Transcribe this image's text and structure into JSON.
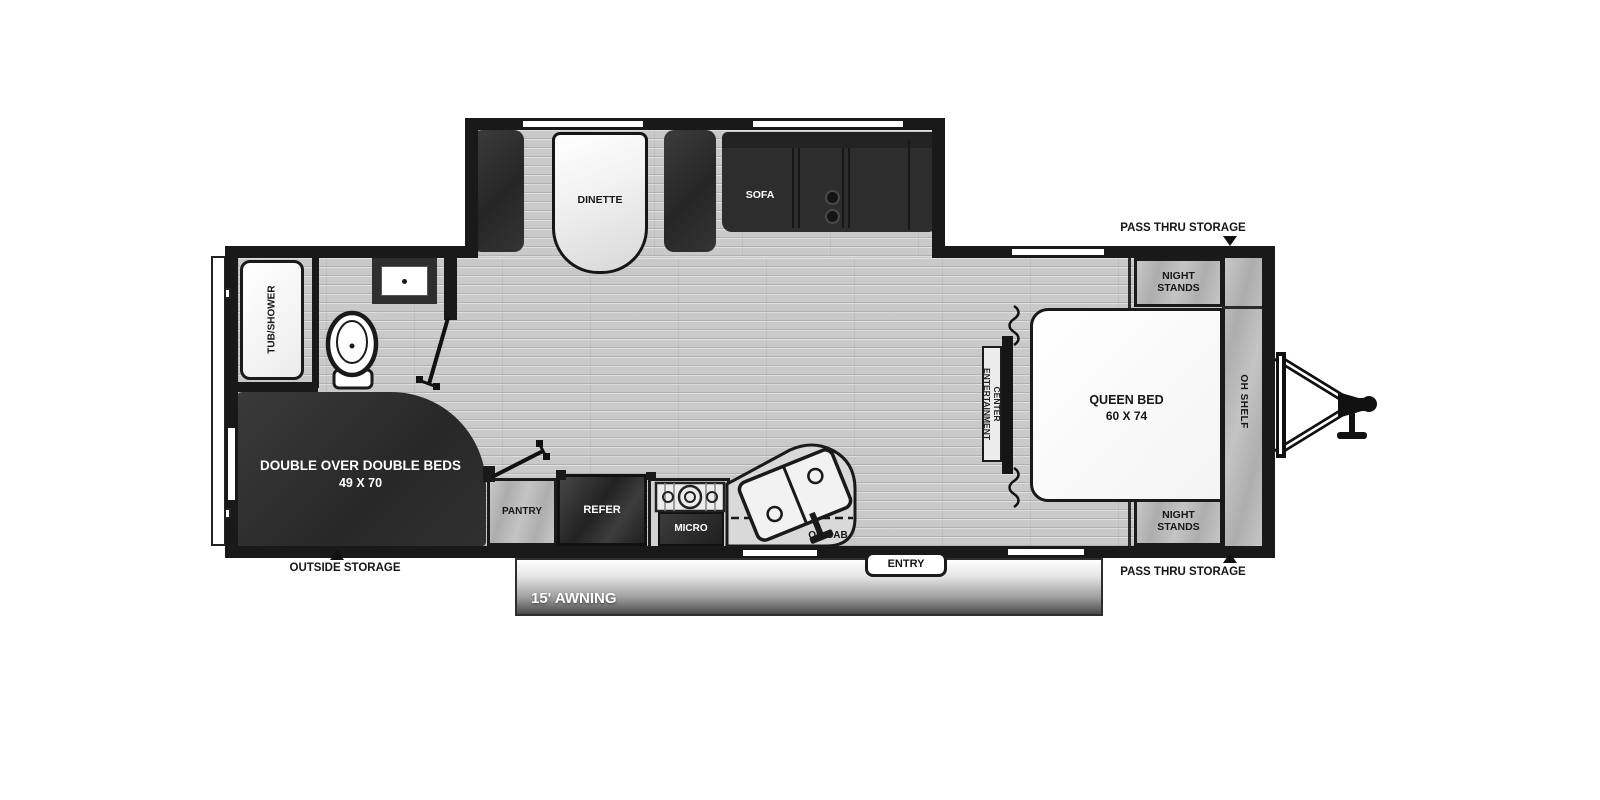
{
  "labels": {
    "dinette": "DINETTE",
    "sofa": "SOFA",
    "tub_shower": "TUB/SHOWER",
    "bunk_beds_line1": "DOUBLE OVER DOUBLE BEDS",
    "bunk_beds_line2": "49 X 70",
    "outside_storage": "OUTSIDE STORAGE",
    "pantry": "PANTRY",
    "refer": "REFER",
    "micro": "MICRO",
    "oh_cab": "OH CAB",
    "entry": "ENTRY",
    "awning": "15' AWNING",
    "pass_thru_top": "PASS THRU STORAGE",
    "pass_thru_bottom": "PASS THRU STORAGE",
    "night_stands_top": "NIGHT STANDS",
    "night_stands_bottom": "NIGHT STANDS",
    "queen_bed_line1": "QUEEN BED",
    "queen_bed_line2": "60 X 74",
    "oh_shelf": "OH SHELF",
    "entertainment_line1": "CENTER",
    "entertainment_line2": "ENTERTAINMENT"
  },
  "colors": {
    "wall": "#191919",
    "floor": "#c9c9c9",
    "dark_furniture": "#2d2d2d",
    "wood_cabinet": "#bdbdbd",
    "fixture_white": "#ffffff",
    "awning_gradient_bottom": "#4a4a4a"
  }
}
